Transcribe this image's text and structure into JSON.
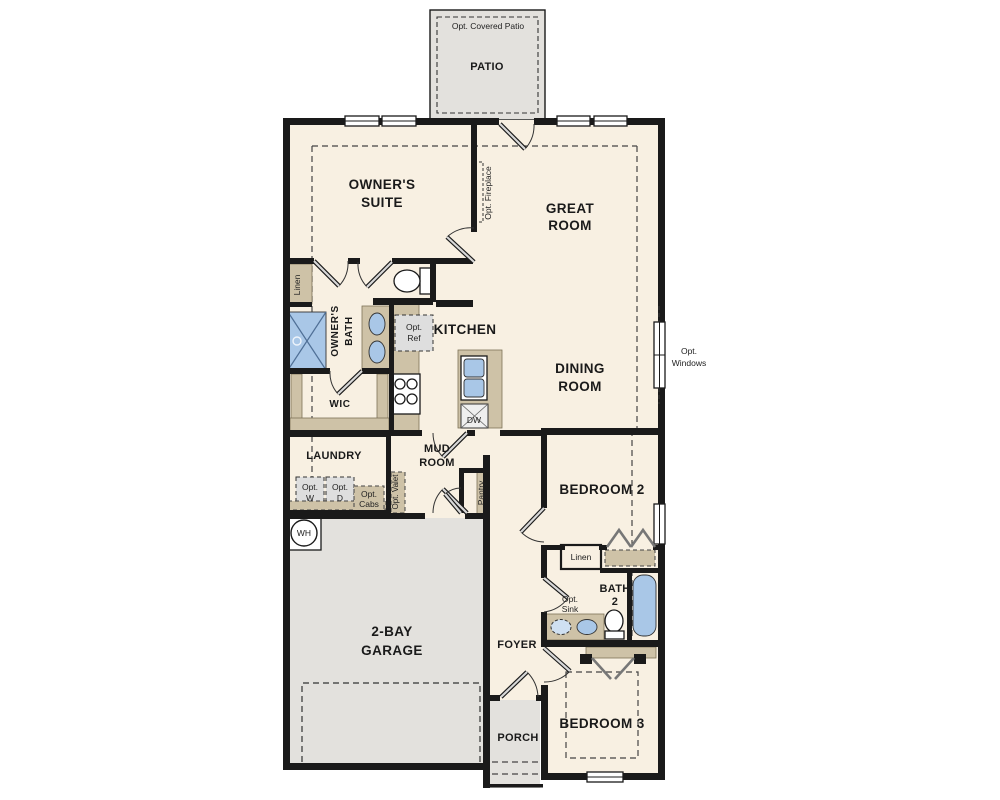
{
  "title": "Single-story house floor plan",
  "colors": {
    "floor": "#f8f0e2",
    "concrete": "#e3e1dd",
    "cabinet": "#cec2a7",
    "fixture_blue": "#a9c7e7",
    "wall": "#1a1a1a",
    "optional_appliance": "#dedede"
  },
  "labels": {
    "opt_covered_patio": "Opt. Covered Patio",
    "patio": "PATIO",
    "owners_suite": [
      "OWNER'S",
      "SUITE"
    ],
    "great_room": [
      "GREAT",
      "ROOM"
    ],
    "opt_fireplace": "Opt. Fireplace",
    "linen_bath": "Linen",
    "owners_bath": [
      "OWNER'S",
      "BATH"
    ],
    "opt_ref": [
      "Opt.",
      "Ref"
    ],
    "kitchen": "KITCHEN",
    "dining_room": [
      "DINING",
      "ROOM"
    ],
    "opt_windows": [
      "Opt.",
      "Windows"
    ],
    "wic": "WIC",
    "laundry": "LAUNDRY",
    "mud_room": [
      "MUD",
      "ROOM"
    ],
    "opt_w": [
      "Opt.",
      "W"
    ],
    "opt_d": [
      "Opt.",
      "D"
    ],
    "opt_cabs": [
      "Opt.",
      "Cabs"
    ],
    "opt_valet": "Opt. Valet",
    "pantry": "Pantry",
    "wh": "WH",
    "dw": "DW",
    "bedroom_2": "BEDROOM 2",
    "linen_hall": "Linen",
    "bath_2": [
      "BATH",
      "2"
    ],
    "opt_sink": [
      "Opt.",
      "Sink"
    ],
    "garage": [
      "2-BAY",
      "GARAGE"
    ],
    "foyer": "FOYER",
    "porch": "PORCH",
    "bedroom_3": "BEDROOM 3"
  }
}
